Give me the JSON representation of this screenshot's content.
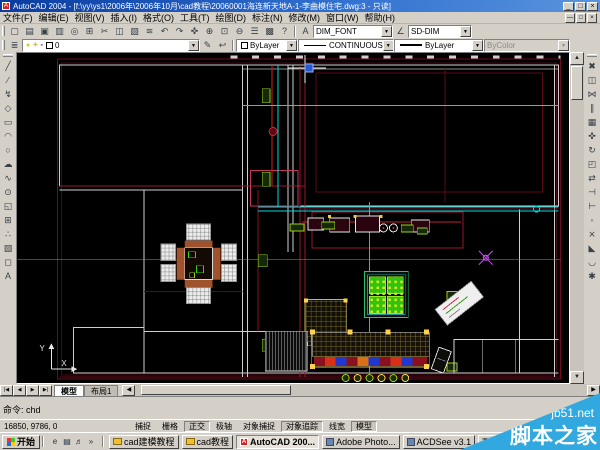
{
  "window": {
    "title": "AutoCAD 2004 - [f:\\yy\\ys1\\2006年\\2006年10月\\cad教程\\20060001海连新天地A-1-李曲模住宅.dwg:3 - 只读]",
    "app_icon_letter": "A",
    "controls": {
      "minimize": "_",
      "restore": "□",
      "close": "×"
    }
  },
  "menu": {
    "items": [
      "文件(F)",
      "编辑(E)",
      "视图(V)",
      "插入(I)",
      "格式(O)",
      "工具(T)",
      "绘图(D)",
      "标注(N)",
      "修改(M)",
      "窗口(W)",
      "帮助(H)"
    ],
    "child_controls": {
      "minimize": "—",
      "restore": "□",
      "close": "×"
    }
  },
  "toolbar_std": {
    "buttons": [
      {
        "name": "new",
        "glyph": "▢"
      },
      {
        "name": "open",
        "glyph": "▤"
      },
      {
        "name": "save",
        "glyph": "▣"
      },
      {
        "name": "plot",
        "glyph": "▥"
      },
      {
        "name": "plot-preview",
        "glyph": "◎"
      },
      {
        "name": "publish",
        "glyph": "⊞"
      },
      {
        "name": "cut",
        "glyph": "✂"
      },
      {
        "name": "copy",
        "glyph": "◫"
      },
      {
        "name": "paste",
        "glyph": "▨"
      },
      {
        "name": "match-properties",
        "glyph": "≋"
      },
      {
        "name": "undo",
        "glyph": "↶"
      },
      {
        "name": "redo",
        "glyph": "↷"
      },
      {
        "name": "pan",
        "glyph": "✜"
      },
      {
        "name": "zoom-realtime",
        "glyph": "⊕"
      },
      {
        "name": "zoom-window",
        "glyph": "⊡"
      },
      {
        "name": "zoom-previous",
        "glyph": "⊖"
      },
      {
        "name": "properties",
        "glyph": "☰"
      },
      {
        "name": "design-center",
        "glyph": "▩"
      },
      {
        "name": "help",
        "glyph": "?"
      }
    ],
    "text_style_icon": "A",
    "text_style_value": "DIM_FONT",
    "dim_style_icon": "∠",
    "dim_style_value": "SD-DIM",
    "arrow": "▼"
  },
  "toolbar_props": {
    "layer_tool_glyph": "≣",
    "layer_icons": [
      {
        "name": "bulb-icon",
        "glyph": "●",
        "color": "#e0c818"
      },
      {
        "name": "sun-icon",
        "glyph": "☀",
        "color": "#d0a010"
      },
      {
        "name": "lock-icon",
        "glyph": "▪",
        "color": "#707890"
      }
    ],
    "layer_value": "0",
    "make-layer-current_glyph": "✎",
    "layer-previous_glyph": "⮌",
    "color_value": "ByLayer",
    "linetype_value": "CONTINUOUS",
    "lineweight_value": "ByLayer",
    "plotstyle_value": "ByColor",
    "arrow": "▼"
  },
  "draw_toolbar": {
    "buttons": [
      {
        "name": "line",
        "glyph": "╱"
      },
      {
        "name": "construction-line",
        "glyph": "∕"
      },
      {
        "name": "polyline",
        "glyph": "↯"
      },
      {
        "name": "polygon",
        "glyph": "◇"
      },
      {
        "name": "rectangle",
        "glyph": "▭"
      },
      {
        "name": "arc",
        "glyph": "◠"
      },
      {
        "name": "circle",
        "glyph": "○"
      },
      {
        "name": "revision-cloud",
        "glyph": "☁"
      },
      {
        "name": "spline",
        "glyph": "∿"
      },
      {
        "name": "ellipse",
        "glyph": "⊙"
      },
      {
        "name": "insert-block",
        "glyph": "◱"
      },
      {
        "name": "make-block",
        "glyph": "⊞"
      },
      {
        "name": "point",
        "glyph": "∴"
      },
      {
        "name": "hatch",
        "glyph": "▨"
      },
      {
        "name": "region",
        "glyph": "◻"
      },
      {
        "name": "multiline-text",
        "glyph": "A"
      }
    ]
  },
  "modify_toolbar": {
    "buttons": [
      {
        "name": "erase",
        "glyph": "✖"
      },
      {
        "name": "copy-object",
        "glyph": "◫"
      },
      {
        "name": "mirror",
        "glyph": "⋈"
      },
      {
        "name": "offset",
        "glyph": "∥"
      },
      {
        "name": "array",
        "glyph": "▦"
      },
      {
        "name": "move",
        "glyph": "✜"
      },
      {
        "name": "rotate",
        "glyph": "↻"
      },
      {
        "name": "scale",
        "glyph": "◰"
      },
      {
        "name": "stretch",
        "glyph": "⇄"
      },
      {
        "name": "trim",
        "glyph": "⊣"
      },
      {
        "name": "extend",
        "glyph": "⊢"
      },
      {
        "name": "break-at-point",
        "glyph": "◦"
      },
      {
        "name": "break",
        "glyph": "⨯"
      },
      {
        "name": "chamfer",
        "glyph": "◣"
      },
      {
        "name": "fillet",
        "glyph": "◡"
      },
      {
        "name": "explode",
        "glyph": "✱"
      }
    ]
  },
  "layout_tabs": {
    "nav": [
      "|◀",
      "◀",
      "▶",
      "▶|"
    ],
    "tabs": [
      {
        "label": "模型",
        "active": true
      },
      {
        "label": "布局1",
        "active": false
      }
    ]
  },
  "command_window": {
    "prompt": "命令: chd"
  },
  "status_bar": {
    "coords": "16850, 9786, 0",
    "toggles": [
      {
        "label": "捕捉",
        "pressed": false
      },
      {
        "label": "栅格",
        "pressed": false
      },
      {
        "label": "正交",
        "pressed": true
      },
      {
        "label": "极轴",
        "pressed": false
      },
      {
        "label": "对象捕捉",
        "pressed": false
      },
      {
        "label": "对象追踪",
        "pressed": true
      },
      {
        "label": "线宽",
        "pressed": false
      },
      {
        "label": "模型",
        "pressed": true
      }
    ]
  },
  "taskbar": {
    "start_label": "开始",
    "quicklaunch": [
      {
        "name": "internet-explorer-icon",
        "glyph": "e"
      },
      {
        "name": "show-desktop-icon",
        "glyph": "▤"
      },
      {
        "name": "media-player-icon",
        "glyph": "♬"
      },
      {
        "name": "quicklaunch-more-icon",
        "glyph": "»"
      }
    ],
    "windows": [
      {
        "label": "cad建模教程",
        "icon": "folder",
        "active": false
      },
      {
        "label": "cad教程",
        "icon": "folder",
        "active": false
      },
      {
        "label": "AutoCAD 200...",
        "icon": "acad",
        "active": true
      },
      {
        "label": "Adobe Photo...",
        "icon": "app",
        "active": false
      },
      {
        "label": "ACDSee v3.1",
        "icon": "app",
        "active": false
      },
      {
        "label": "TTT",
        "icon": "",
        "active": false
      }
    ]
  },
  "watermark": {
    "site": "jb51.net",
    "name": "脚本之家",
    "color": "#31a8e0"
  },
  "colors": {
    "canvas_bg": "#000000",
    "wall_white": "#cfcfcf",
    "outer_maroon": "#6b0d1d",
    "accent_red": "#d02028",
    "cyan": "#00dcdc",
    "green": "#35d414",
    "label_green": "#9ad014",
    "yellow": "#ffd24d",
    "purple": "#b44fd8"
  }
}
